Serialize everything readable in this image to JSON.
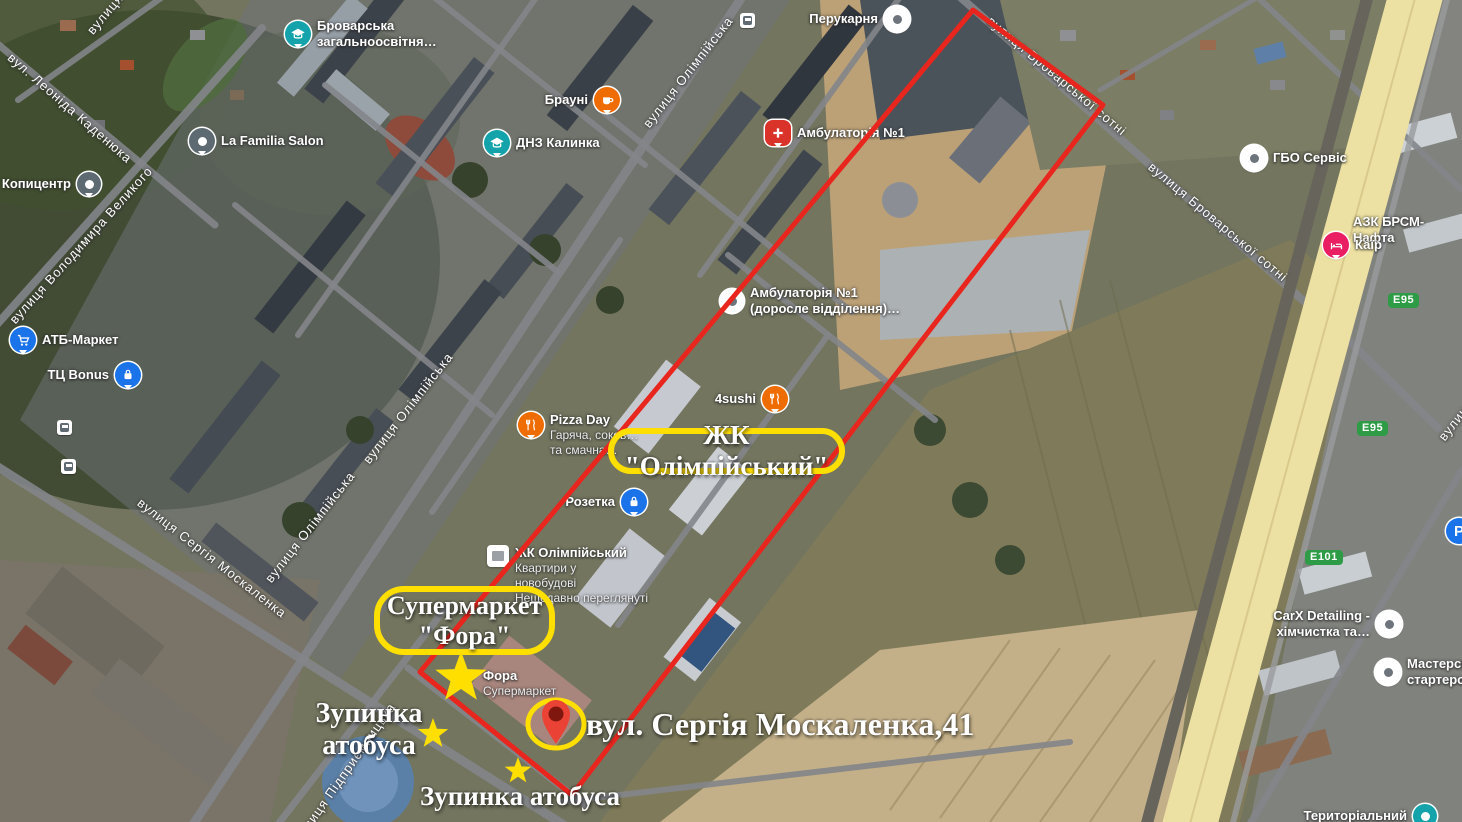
{
  "annotations": {
    "highlight_color": "#FFDF00",
    "boundary_color": "#E8261E",
    "pin_color": "#EA4335",
    "zk_box_label": "ЖК \"Олімпійський\"",
    "fora_box_line1": "Супермаркет",
    "fora_box_line2": "\"Фора\"",
    "address_label": "вул. Сергія Москаленка,41",
    "bus_stop_left_line1": "Зупинка",
    "bus_stop_left_line2": "атобуса",
    "bus_stop_bottom_label": "Зупинка атобуса",
    "stars": [
      "fora-star-large",
      "bus-stop-star-west",
      "bus-stop-star-south"
    ]
  },
  "shields": {
    "e95_top": "E95",
    "e95_mid": "E95",
    "e101": "E101"
  },
  "streets": {
    "olimpiiska_top": "вулиця Олімпійська",
    "olimpiiska_mid": "вулиця Олімпійська",
    "olimpiiska_low": "вулиця Олімпійська",
    "moskalenka": "вулиця Сергія Москаленка",
    "velykoho": "вулиця Володимира Великого",
    "kadeniuka": "вул. Леоніда Каденюка",
    "brovarskoi_1": "вулиця Броварської сотні",
    "brovarskoi_2": "вулиця Броварської сотні",
    "pidpryiemnytska": "вулиця Підприємницька",
    "partial_topleft": "вулиця",
    "partial_right": "вулиця"
  },
  "pois": {
    "school": {
      "line1": "Броварська",
      "line2": "загальноосвітня…"
    },
    "perukarnia": {
      "label": "Перукарня"
    },
    "brauni": {
      "label": "Брауні"
    },
    "dnz": {
      "label": "ДНЗ Калинка"
    },
    "ambulatoria1": {
      "label": "Амбулаторія №1"
    },
    "ambulatoria_adult": {
      "line1": "Амбулаторія №1",
      "line2": "(доросле відділення)…"
    },
    "sushi": {
      "label": "4sushi"
    },
    "pizza": {
      "title": "Pizza Day",
      "line1": "Гаряча, соков…",
      "line2": "та смачна…"
    },
    "rozetka": {
      "label": "Розетка"
    },
    "zhk_card": {
      "title": "ЖК Олімпійський",
      "line1": "Квартири у",
      "line2": "новобудові",
      "line3": "Нещодавно переглянуті"
    },
    "fora": {
      "title": "Фора",
      "subtitle": "Супермаркет"
    },
    "lafamilia": {
      "label": "La Familia Salon"
    },
    "kopytsentr": {
      "label": "Копицентр"
    },
    "atb": {
      "label": "АТБ-Маркет"
    },
    "bonus": {
      "label": "ТЦ Bonus"
    },
    "gbo": {
      "label": "ГБО Сервіс"
    },
    "azs": {
      "label": "АЗК БРСМ-Нафта"
    },
    "kair": {
      "label": "Каїр"
    },
    "carx": {
      "line1": "CarX Detailing -",
      "line2": "хімчистка та…"
    },
    "starter": {
      "line1": "Мастерская",
      "line2": "стартеров"
    },
    "terytorialnyi": {
      "label": "Територіальний"
    },
    "parking": {
      "label": "P"
    }
  }
}
